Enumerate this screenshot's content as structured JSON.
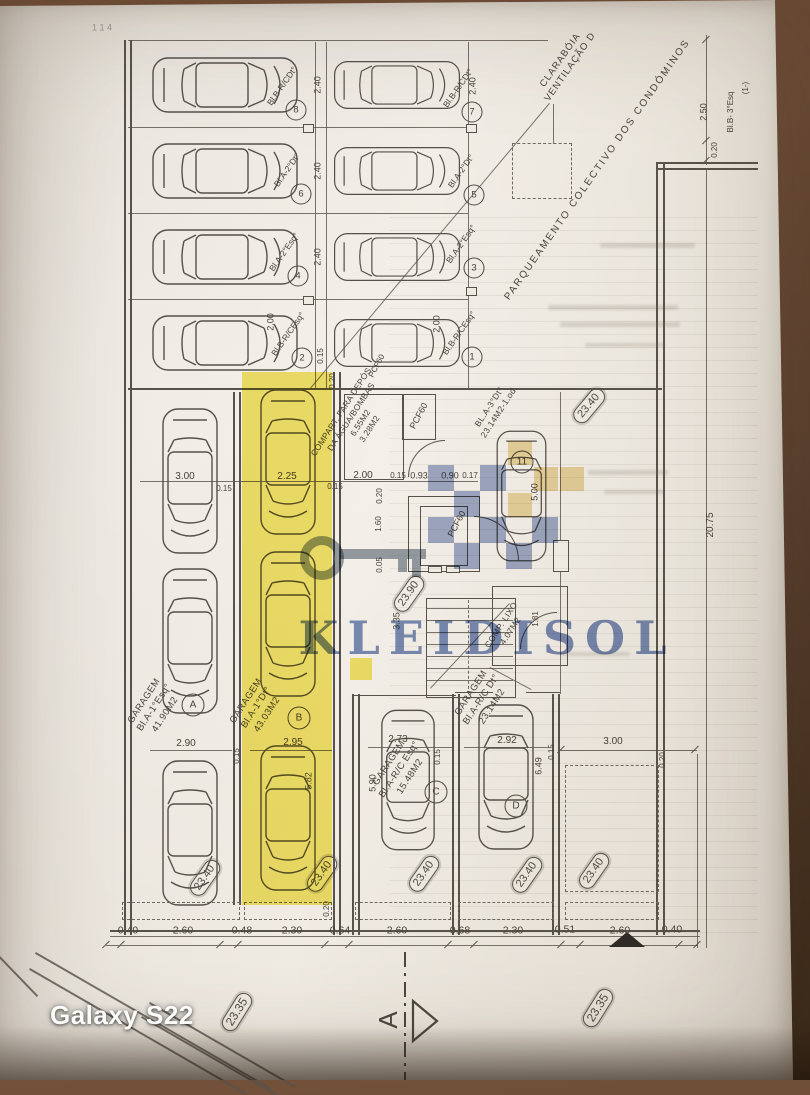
{
  "camera": {
    "watermark": "Galaxy S22"
  },
  "brand": {
    "name": "KLEIDISOL"
  },
  "notes": {
    "claraboia_l1": "CLARABÓIA",
    "claraboia_l2": "VENTILAÇÃO D",
    "parqueamento": "PARQUEAMENTO COLECTIVO DOS CONDÓMINOS",
    "corner_ref": "Bl.B- 3°Esq",
    "corner_ref2": "(1-)",
    "faint_marks": "1 1 4"
  },
  "stalls": [
    {
      "num": "8",
      "label": "Bl.B-R/CDt°"
    },
    {
      "num": "6",
      "label": "Bl.A-2°Dt°"
    },
    {
      "num": "4",
      "label": "Bl.A-2°Esq°"
    },
    {
      "num": "2",
      "label": "Bl.B-R/CEsq°"
    },
    {
      "num": "7",
      "label": "Bl.B-R/CDt°"
    },
    {
      "num": "5",
      "label": "Bl.A-2°Dt°"
    },
    {
      "num": "3",
      "label": "Bl.A-2°Esq°"
    },
    {
      "num": "1",
      "label": "Bl.B-R/CEsq°"
    }
  ],
  "garages": {
    "a": {
      "name": "GARAGEM",
      "unit": "Bl.A-1°Esq°",
      "area": "41.90M2",
      "badge": "A"
    },
    "b": {
      "name": "GARAGEM",
      "unit": "Bl.A-1°Dt°",
      "area": "43.03M2",
      "badge": "B"
    },
    "c": {
      "name": "GARAGEM",
      "unit": "Bl.A-R/C Esq°",
      "area": "15.48M2",
      "badge": "C"
    },
    "d": {
      "name": "GARAGEM",
      "unit": "Bl.A-R/C Dt°",
      "area": "23.14M2",
      "badge": "D"
    },
    "u11": {
      "unit": "BL.A-3°Dt°",
      "area": "23.14M2-1.od",
      "badge": "11"
    }
  },
  "rooms": {
    "compart_l1": "COMPART. PARA DEPÓS.",
    "compart_l2": "DA ÁGUA/BOMBAS",
    "compart_a1": "6.55M2",
    "compart_a2": "3.28M2",
    "pcf": "PCF60",
    "lixo_l1": "COMP. LIXO",
    "lixo_l2": "4.07M2"
  },
  "levels": {
    "v2390": "23.90",
    "v2340": "23.40",
    "v2335": "23.35"
  },
  "dims": {
    "chain": [
      "0.40",
      "2.60",
      "0.48",
      "2.30",
      "0.64",
      "2.60",
      "0.68",
      "2.30",
      "0.51",
      "2.60",
      "0.40"
    ],
    "v240": "2.40",
    "v015": "0.15",
    "v200": "2.00",
    "v250": "2.50",
    "v020": "0.20",
    "v2075": "20.75",
    "v300": "3.00",
    "v225": "2.25",
    "v093": "0.93",
    "v090": "0.90",
    "v017": "0.17",
    "v160": "1.60",
    "v005": "0.05",
    "v335": "3.35",
    "v500": "5.00",
    "v582": "5.82",
    "v590": "5.90",
    "v649": "6.49",
    "v181": "1.81",
    "v290": "2.90",
    "v295": "2.95",
    "v273": "2.73",
    "v292": "2.92"
  },
  "section": {
    "letter": "A"
  },
  "colors": {
    "highlight": "#f2e24a",
    "watermark_blue": "#6f87bf",
    "watermark_gold": "#e2c36c",
    "paper": "#e9e4dc",
    "table": "#5d4230"
  }
}
